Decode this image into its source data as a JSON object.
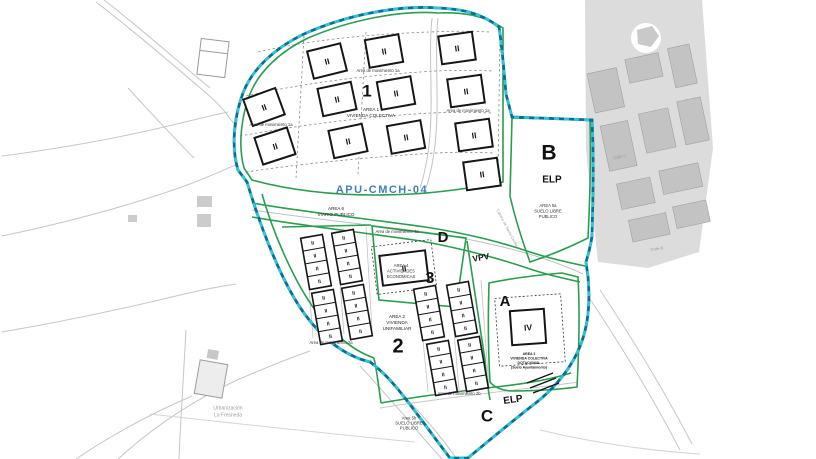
{
  "plan": {
    "code": "APU-CMCH-04"
  },
  "labels": {
    "ii": "II",
    "iv": "IV"
  },
  "area1": {
    "number": "1",
    "title1": "AREA 1",
    "title2": "VIVIENDA COLECTIVA",
    "mov_top": "Area de movimiento 1a",
    "mov_left": "Area de movimiento 1a",
    "mov_right": "Area de movimiento 1a"
  },
  "area2": {
    "number": "2",
    "title1": "AREA 2",
    "title2": "VIVIENDA",
    "title3": "UNIFAMILIAR",
    "mov_left": "Area de movimiento 2a",
    "mov_right": "Area de movimiento 2b"
  },
  "area4": {
    "number": "3",
    "title1": "AREA 4",
    "title2": "ACTIVIDADES",
    "title3": "ECONOMICAS",
    "mov": "Area de movimiento 4a"
  },
  "areaA": {
    "letter": "A",
    "note1": "AREA 3",
    "note2": "VIVIENDA COLECTIVA",
    "note3": "DOTACIONAL",
    "note4": "(Suelo Ayuntamiento)"
  },
  "areaB": {
    "letter": "B",
    "tag": "ELP",
    "title1": "AREA 5a",
    "title2": "SUELO LIBRE",
    "title3": "PUBLICO"
  },
  "areaC": {
    "letter": "C",
    "tag": "ELP",
    "title1": "Area 5b",
    "title2": "SUELO LIBRE",
    "title3": "PUBLICO"
  },
  "areaD": {
    "letter": "D",
    "tag": "VPV",
    "title1": "AREA 6",
    "title2": "VIARIO PUBLICO"
  },
  "context": {
    "neigh1": "Urbanización",
    "neigh2": "La Fresneda",
    "street1": "Calle G",
    "street2": "Calle B",
    "road": "Camino de Santa Cecilia"
  },
  "colors": {
    "green": "#2a9d4f",
    "teal": "#2cc3dd",
    "teal_dark": "#0b6e8e",
    "blue": "#3d7fc1",
    "black": "#161616",
    "gray": "#9b9b9b"
  }
}
